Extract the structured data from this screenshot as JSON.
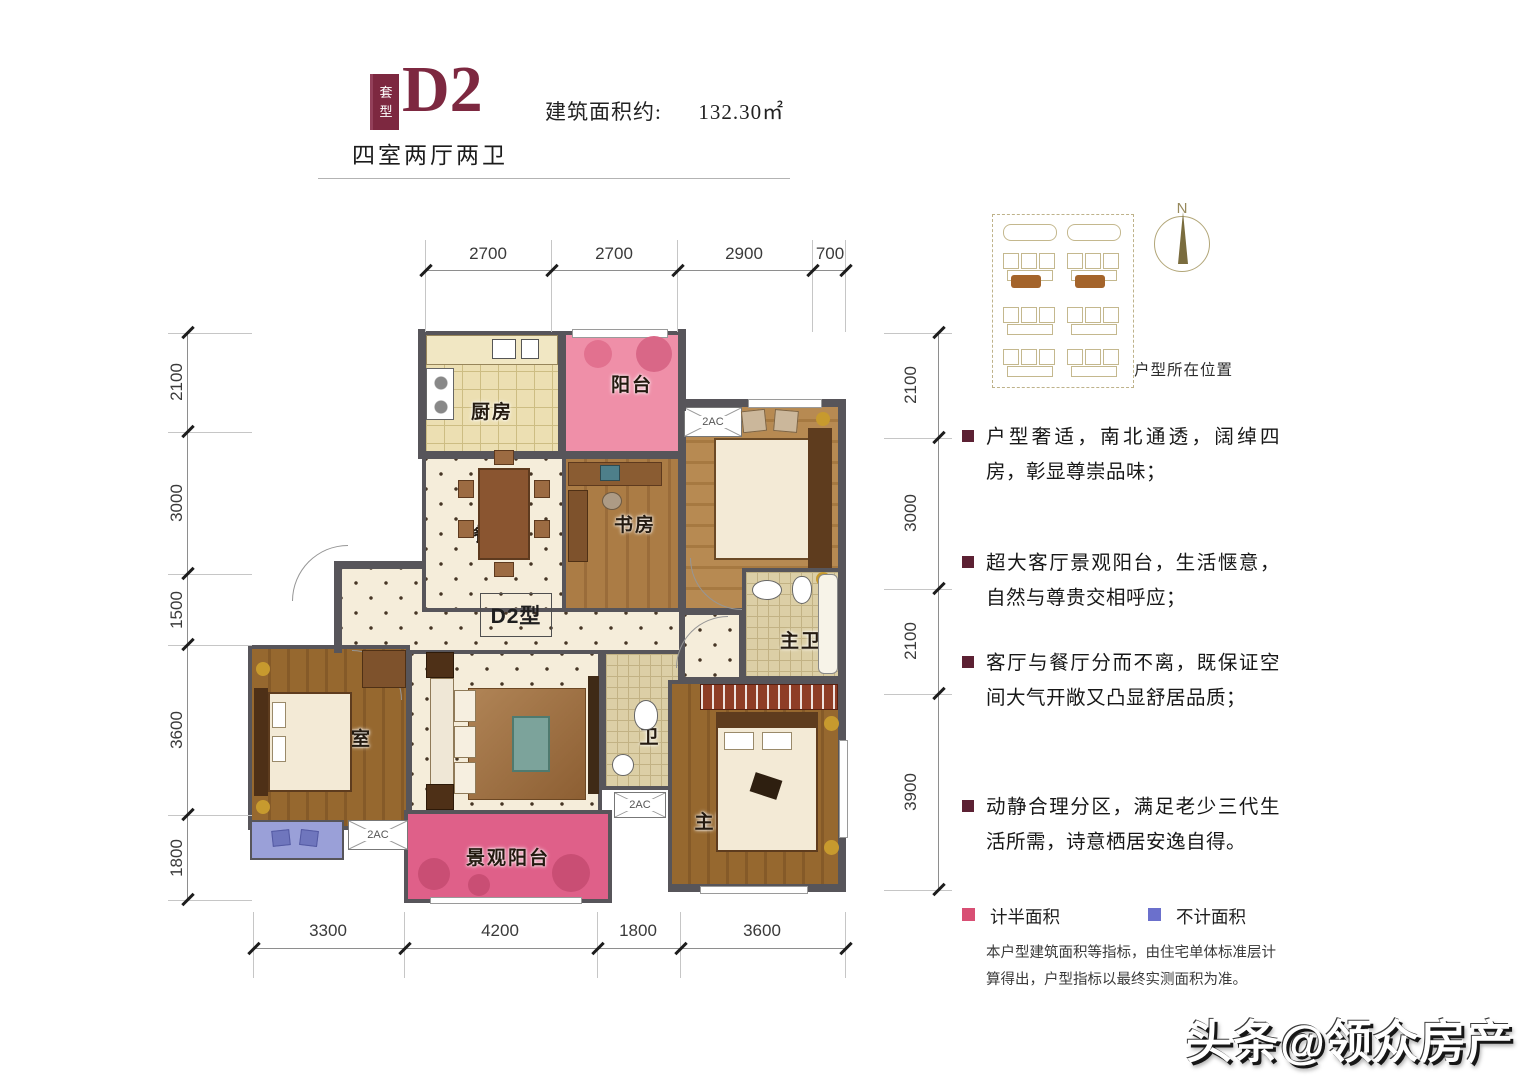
{
  "header": {
    "badge_top": "套",
    "badge_bottom": "型",
    "unit_code": "D2",
    "area_label": "建筑面积约:",
    "area_value": "132.30㎡",
    "layout_type": "四室两厅两卫"
  },
  "dims": {
    "top": [
      "2700",
      "2700",
      "2900",
      "700"
    ],
    "left": [
      "2100",
      "3000",
      "1500",
      "3600",
      "1800"
    ],
    "right": [
      "2100",
      "3000",
      "2100",
      "3900"
    ],
    "bottom": [
      "3300",
      "4200",
      "1800",
      "3600"
    ]
  },
  "plan": {
    "unit_label": "D2型",
    "ac_label": "2AC",
    "rooms": {
      "kitchen": "厨房",
      "balcony": "阳台",
      "study": "书房",
      "bedroom_top": "卧室",
      "dining": "餐厅",
      "living": "客厅",
      "bath": "卫",
      "master_bath": "主卫",
      "master_bedroom": "主卧室",
      "bedroom_left": "卧室",
      "view_balcony": "景观阳台"
    }
  },
  "sidebar": {
    "compass_label": "N",
    "location_label": "户型所在位置",
    "bullets": [
      "户型奢适，南北通透，阔绰四房，彰显尊崇品味；",
      "超大客厅景观阳台，生活惬意，自然与尊贵交相呼应；",
      "客厅与餐厅分而不离，既保证空间大气开敞又凸显舒居品质；",
      "动静合理分区，满足老少三代生活所需，诗意栖居安逸自得。"
    ],
    "legend": [
      {
        "label": "计半面积",
        "color": "#d84f74"
      },
      {
        "label": "不计面积",
        "color": "#6b70cc"
      }
    ],
    "note": "本户型建筑面积等指标，由住宅单体标准层计算得出，户型指标以最终实测面积为准。"
  },
  "watermark": "头条@领众房产",
  "colors": {
    "accent_maroon": "#7d2840",
    "legend_pink": "#d84f74",
    "legend_blue": "#6b70cc",
    "balcony_pink": "#ef8fa8",
    "view_balcony_pink": "#df6089",
    "no_area_blue": "#9aa0d8",
    "wall_gray": "#57555a"
  }
}
